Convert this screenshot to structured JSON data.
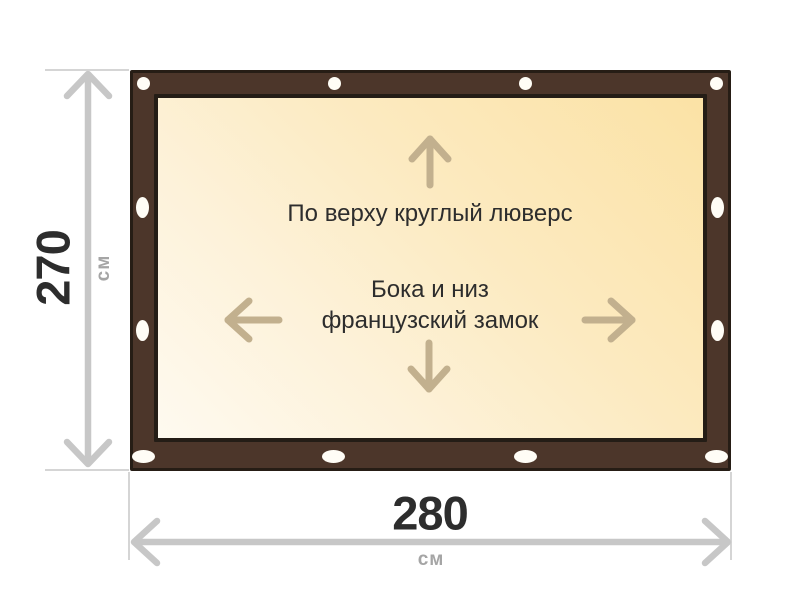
{
  "diagram": {
    "title": "tarp-size-diagram",
    "panel_labels": {
      "top": "По верху круглый люверс",
      "middle_line1": "Бока и низ",
      "middle_line2": "французский замок"
    },
    "dimensions": {
      "height": {
        "value": "270",
        "unit": "см"
      },
      "width": {
        "value": "280",
        "unit": "см"
      }
    },
    "icons": [
      "up-arrow-icon",
      "down-arrow-icon",
      "left-arrow-icon",
      "right-arrow-icon",
      "vertical-dimension-arrow-icon",
      "horizontal-dimension-arrow-icon",
      "grommet-icon"
    ],
    "colors": {
      "frame_brown": "#4c362a",
      "frame_outline": "#261d15",
      "panel_gradient_dark": "#fbe2a5",
      "panel_gradient_light": "#fefaf0",
      "panel_border": "#241d16",
      "arrow_tan": "#c2b08e",
      "dimension_gray": "#c7c7c7",
      "extension_gray": "#d5d5d5",
      "number_dark": "#2d2d2d",
      "unit_gray": "#a5a5a5",
      "grommet_white": "#fffdf6",
      "background": "#ffffff"
    }
  }
}
